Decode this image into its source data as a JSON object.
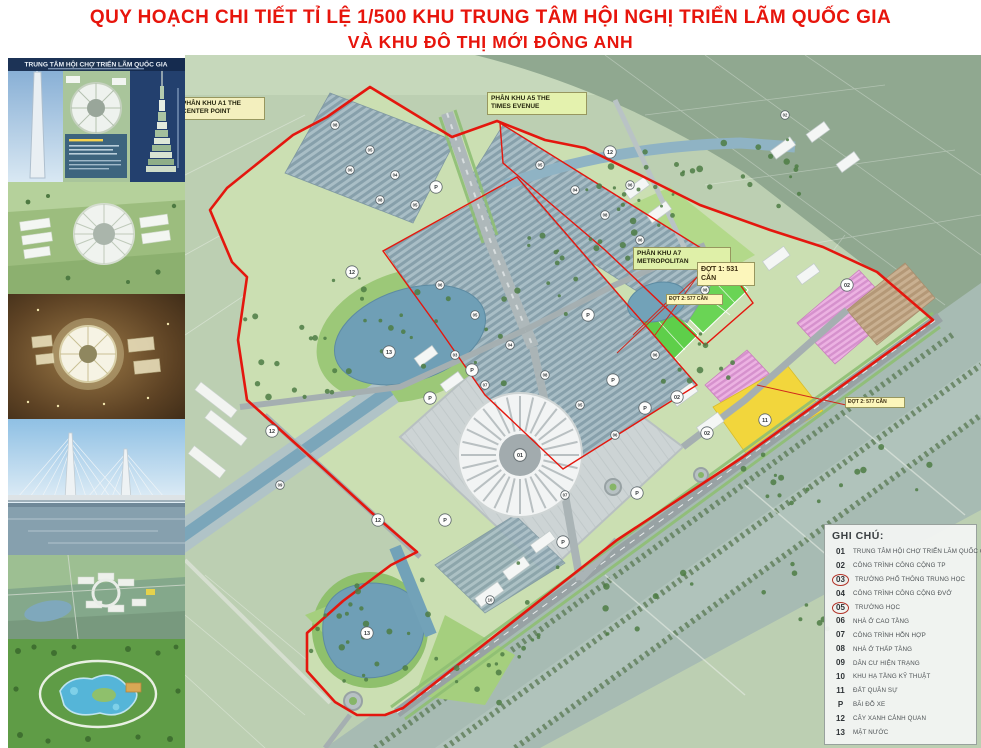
{
  "title": {
    "line1": "QUY HOẠCH CHI TIẾT TỈ LỆ 1/500 KHU TRUNG TÂM HỘI NGHỊ TRIỂN LÃM QUỐC GIA",
    "line2": "VÀ KHU ĐÔ THỊ MỚI ĐÔNG ANH"
  },
  "sidebar": {
    "header": "TRUNG TÂM HỘI CHỢ TRIỂN LÃM QUỐC GIA",
    "thumbnails": [
      {
        "name": "tower-montage"
      },
      {
        "name": "exhibition-aerial-day"
      },
      {
        "name": "exhibition-aerial-night"
      },
      {
        "name": "cable-stayed-bridge"
      },
      {
        "name": "urban-area-aerial"
      },
      {
        "name": "water-park-aerial"
      }
    ]
  },
  "map": {
    "labels": [
      {
        "text": "PHÂN KHU A1 THE\nCENTER POINT",
        "x": 178,
        "y": 97,
        "w": 87,
        "bg": "#f3efbe",
        "cls": ""
      },
      {
        "text": "PHÂN KHU A5 THE\nTIMES EVENUE",
        "x": 487,
        "y": 92,
        "w": 100,
        "bg": "#e4f2ae",
        "cls": ""
      },
      {
        "text": "PHÂN KHU A7\nMETROPOLITAN",
        "x": 633,
        "y": 247,
        "w": 98,
        "bg": "#dff0a8",
        "cls": ""
      },
      {
        "text": "ĐỢT 1: 531\nCĂN",
        "x": 697,
        "y": 262,
        "w": 58,
        "bg": "#fcf6bb",
        "cls": "dot"
      },
      {
        "text": "ĐỢT 2: 577 CĂN",
        "x": 666,
        "y": 294,
        "w": 57,
        "bg": "#fcf6bb",
        "cls": "dot-sm"
      },
      {
        "text": "ĐỢT 2: 577 CĂN",
        "x": 845,
        "y": 397,
        "w": 60,
        "bg": "#fcf6bb",
        "cls": "dot-sm"
      }
    ],
    "legend": {
      "title": "GHI CHÚ:",
      "items": [
        {
          "key": "01",
          "text": "TRUNG TÂM HỘI CHỢ TRIỂN LÃM QUỐC GIA",
          "circled": false
        },
        {
          "key": "02",
          "text": "CÔNG TRÌNH CÔNG CỘNG TP",
          "circled": false
        },
        {
          "key": "03",
          "text": "TRƯỜNG PHỔ THÔNG TRUNG HỌC",
          "circled": true
        },
        {
          "key": "04",
          "text": "CÔNG TRÌNH CÔNG CỘNG ĐVỞ",
          "circled": false
        },
        {
          "key": "05",
          "text": "TRƯỜNG HỌC",
          "circled": true
        },
        {
          "key": "06",
          "text": "NHÀ Ở CAO TẦNG",
          "circled": false
        },
        {
          "key": "07",
          "text": "CÔNG TRÌNH HỖN HỢP",
          "circled": false
        },
        {
          "key": "08",
          "text": "NHÀ Ở THẤP TẦNG",
          "circled": false
        },
        {
          "key": "09",
          "text": "DÂN CƯ HIỆN TRẠNG",
          "circled": false
        },
        {
          "key": "10",
          "text": "KHU HẠ TẦNG KỸ THUẬT",
          "circled": false
        },
        {
          "key": "11",
          "text": "ĐẤT QUÂN SỰ",
          "circled": false
        },
        {
          "key": "P",
          "text": "BÃI ĐỖ XE",
          "circled": false
        },
        {
          "key": "12",
          "text": "CÂY XANH CẢNH QUAN",
          "circled": false
        },
        {
          "key": "13",
          "text": "MẶT NƯỚC",
          "circled": false
        }
      ]
    },
    "markers": [
      {
        "n": "01",
        "x": 335,
        "y": 400,
        "sm": false
      },
      {
        "n": "13",
        "x": 204,
        "y": 297,
        "sm": false
      },
      {
        "n": "13",
        "x": 182,
        "y": 578,
        "sm": false
      },
      {
        "n": "12",
        "x": 87,
        "y": 376,
        "sm": false
      },
      {
        "n": "12",
        "x": 193,
        "y": 465,
        "sm": false
      },
      {
        "n": "12",
        "x": 167,
        "y": 217,
        "sm": false
      },
      {
        "n": "12",
        "x": 425,
        "y": 97,
        "sm": false
      },
      {
        "n": "11",
        "x": 580,
        "y": 365,
        "sm": false
      },
      {
        "n": "P",
        "x": 245,
        "y": 343,
        "sm": false
      },
      {
        "n": "P",
        "x": 287,
        "y": 315,
        "sm": false
      },
      {
        "n": "P",
        "x": 428,
        "y": 325,
        "sm": false
      },
      {
        "n": "P",
        "x": 460,
        "y": 353,
        "sm": false
      },
      {
        "n": "P",
        "x": 452,
        "y": 438,
        "sm": false
      },
      {
        "n": "P",
        "x": 378,
        "y": 487,
        "sm": false
      },
      {
        "n": "P",
        "x": 260,
        "y": 465,
        "sm": false
      },
      {
        "n": "P",
        "x": 251,
        "y": 132,
        "sm": false
      },
      {
        "n": "P",
        "x": 403,
        "y": 260,
        "sm": false
      },
      {
        "n": "02",
        "x": 662,
        "y": 230,
        "sm": false
      },
      {
        "n": "02",
        "x": 492,
        "y": 342,
        "sm": false
      },
      {
        "n": "02",
        "x": 522,
        "y": 378,
        "sm": false
      },
      {
        "n": "08",
        "x": 150,
        "y": 70,
        "sm": true
      },
      {
        "n": "05",
        "x": 185,
        "y": 95,
        "sm": true
      },
      {
        "n": "06",
        "x": 165,
        "y": 115,
        "sm": true
      },
      {
        "n": "04",
        "x": 210,
        "y": 120,
        "sm": true
      },
      {
        "n": "08",
        "x": 195,
        "y": 145,
        "sm": true
      },
      {
        "n": "05",
        "x": 230,
        "y": 150,
        "sm": true
      },
      {
        "n": "05",
        "x": 355,
        "y": 110,
        "sm": true
      },
      {
        "n": "04",
        "x": 390,
        "y": 135,
        "sm": true
      },
      {
        "n": "08",
        "x": 420,
        "y": 160,
        "sm": true
      },
      {
        "n": "06",
        "x": 455,
        "y": 185,
        "sm": true
      },
      {
        "n": "05",
        "x": 485,
        "y": 210,
        "sm": true
      },
      {
        "n": "08",
        "x": 520,
        "y": 235,
        "sm": true
      },
      {
        "n": "06",
        "x": 255,
        "y": 230,
        "sm": true
      },
      {
        "n": "05",
        "x": 290,
        "y": 260,
        "sm": true
      },
      {
        "n": "04",
        "x": 325,
        "y": 290,
        "sm": true
      },
      {
        "n": "08",
        "x": 360,
        "y": 320,
        "sm": true
      },
      {
        "n": "07",
        "x": 300,
        "y": 330,
        "sm": true
      },
      {
        "n": "03",
        "x": 270,
        "y": 300,
        "sm": true
      },
      {
        "n": "05",
        "x": 395,
        "y": 350,
        "sm": true
      },
      {
        "n": "06",
        "x": 430,
        "y": 380,
        "sm": true
      },
      {
        "n": "10",
        "x": 305,
        "y": 545,
        "sm": true
      },
      {
        "n": "09",
        "x": 95,
        "y": 430,
        "sm": true
      },
      {
        "n": "07",
        "x": 380,
        "y": 440,
        "sm": true
      },
      {
        "n": "06",
        "x": 470,
        "y": 300,
        "sm": true
      },
      {
        "n": "06",
        "x": 445,
        "y": 130,
        "sm": true
      },
      {
        "n": "02",
        "x": 600,
        "y": 60,
        "sm": true
      }
    ]
  },
  "colors": {
    "title_red": "#e7150c",
    "boundary_red": "#e4170e",
    "water": "#72a2b8",
    "sports_green": "#5ecf4a",
    "residential_pink": "#e9a8e0",
    "military_yellow": "#f2d63c",
    "plaza_gray": "#ccd4d5"
  }
}
